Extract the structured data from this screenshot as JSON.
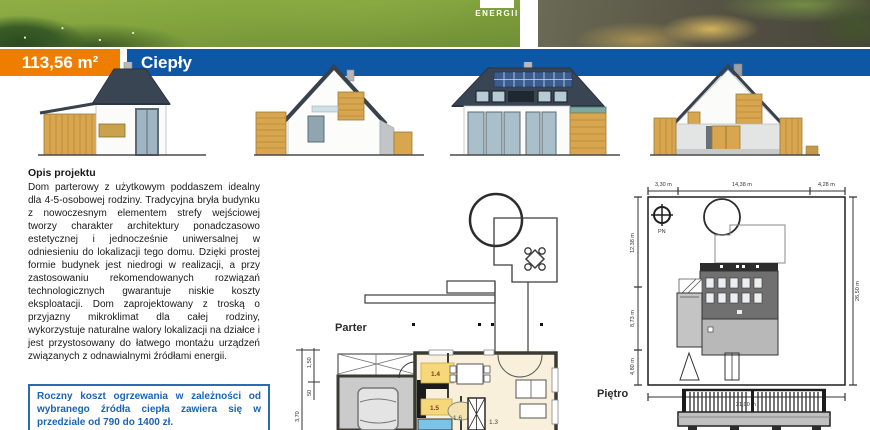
{
  "header": {
    "area_badge": "113,56 m²",
    "project_name": "Ciepły",
    "photo_logo_text": "ENERGII",
    "accent_orange": "#ee7d00",
    "accent_blue": "#0d57a4"
  },
  "description": {
    "heading": "Opis projektu",
    "body": "Dom parterowy z użytkowym poddaszem idealny dla 4-5-osobowej rodziny. Tradycyjna bryła budynku z nowoczesnym elementem strefy wejściowej tworzy charakter architektury ponadczasowo estetycznej i jednocześnie uniwersalnej w odniesieniu do lokalizacji tego domu. Dzięki prostej formie budynek jest niedrogi w realizacji, a przy zastosowaniu rekomendowanych rozwiązań technologicznych gwarantuje niskie koszty eksploatacji. Dom zaprojektowany z troską o przyjazny mikroklimat dla całej rodziny, wykorzystuje naturalne walory lokalizacji na działce i jest przystosowany do łatwego montażu urządzeń związanych z odnawialnymi źródłami energii.",
    "cost_note": "Roczny koszt ogrzewania w zależności od wybranego źródła ciepła zawiera się w przedziale od 790 do 1400 zł."
  },
  "floor_plan": {
    "label": "Parter",
    "rooms": {
      "r14": "1.4",
      "r15": "1.5",
      "r16": "1.6",
      "r13": "1.3"
    },
    "dims": {
      "d1": "1,50",
      "d2": "50",
      "d3": "3,70"
    }
  },
  "upper_plan": {
    "label": "Piętro"
  },
  "site_plan": {
    "compass": "PN",
    "dim_top": [
      "3,30 m",
      "14,38 m",
      "4,28 m"
    ],
    "dim_left": [
      "12,38 m",
      "8,73 m",
      "4,80 m"
    ],
    "dim_right": "26,50 m",
    "dim_bottom": "21,00 m"
  }
}
